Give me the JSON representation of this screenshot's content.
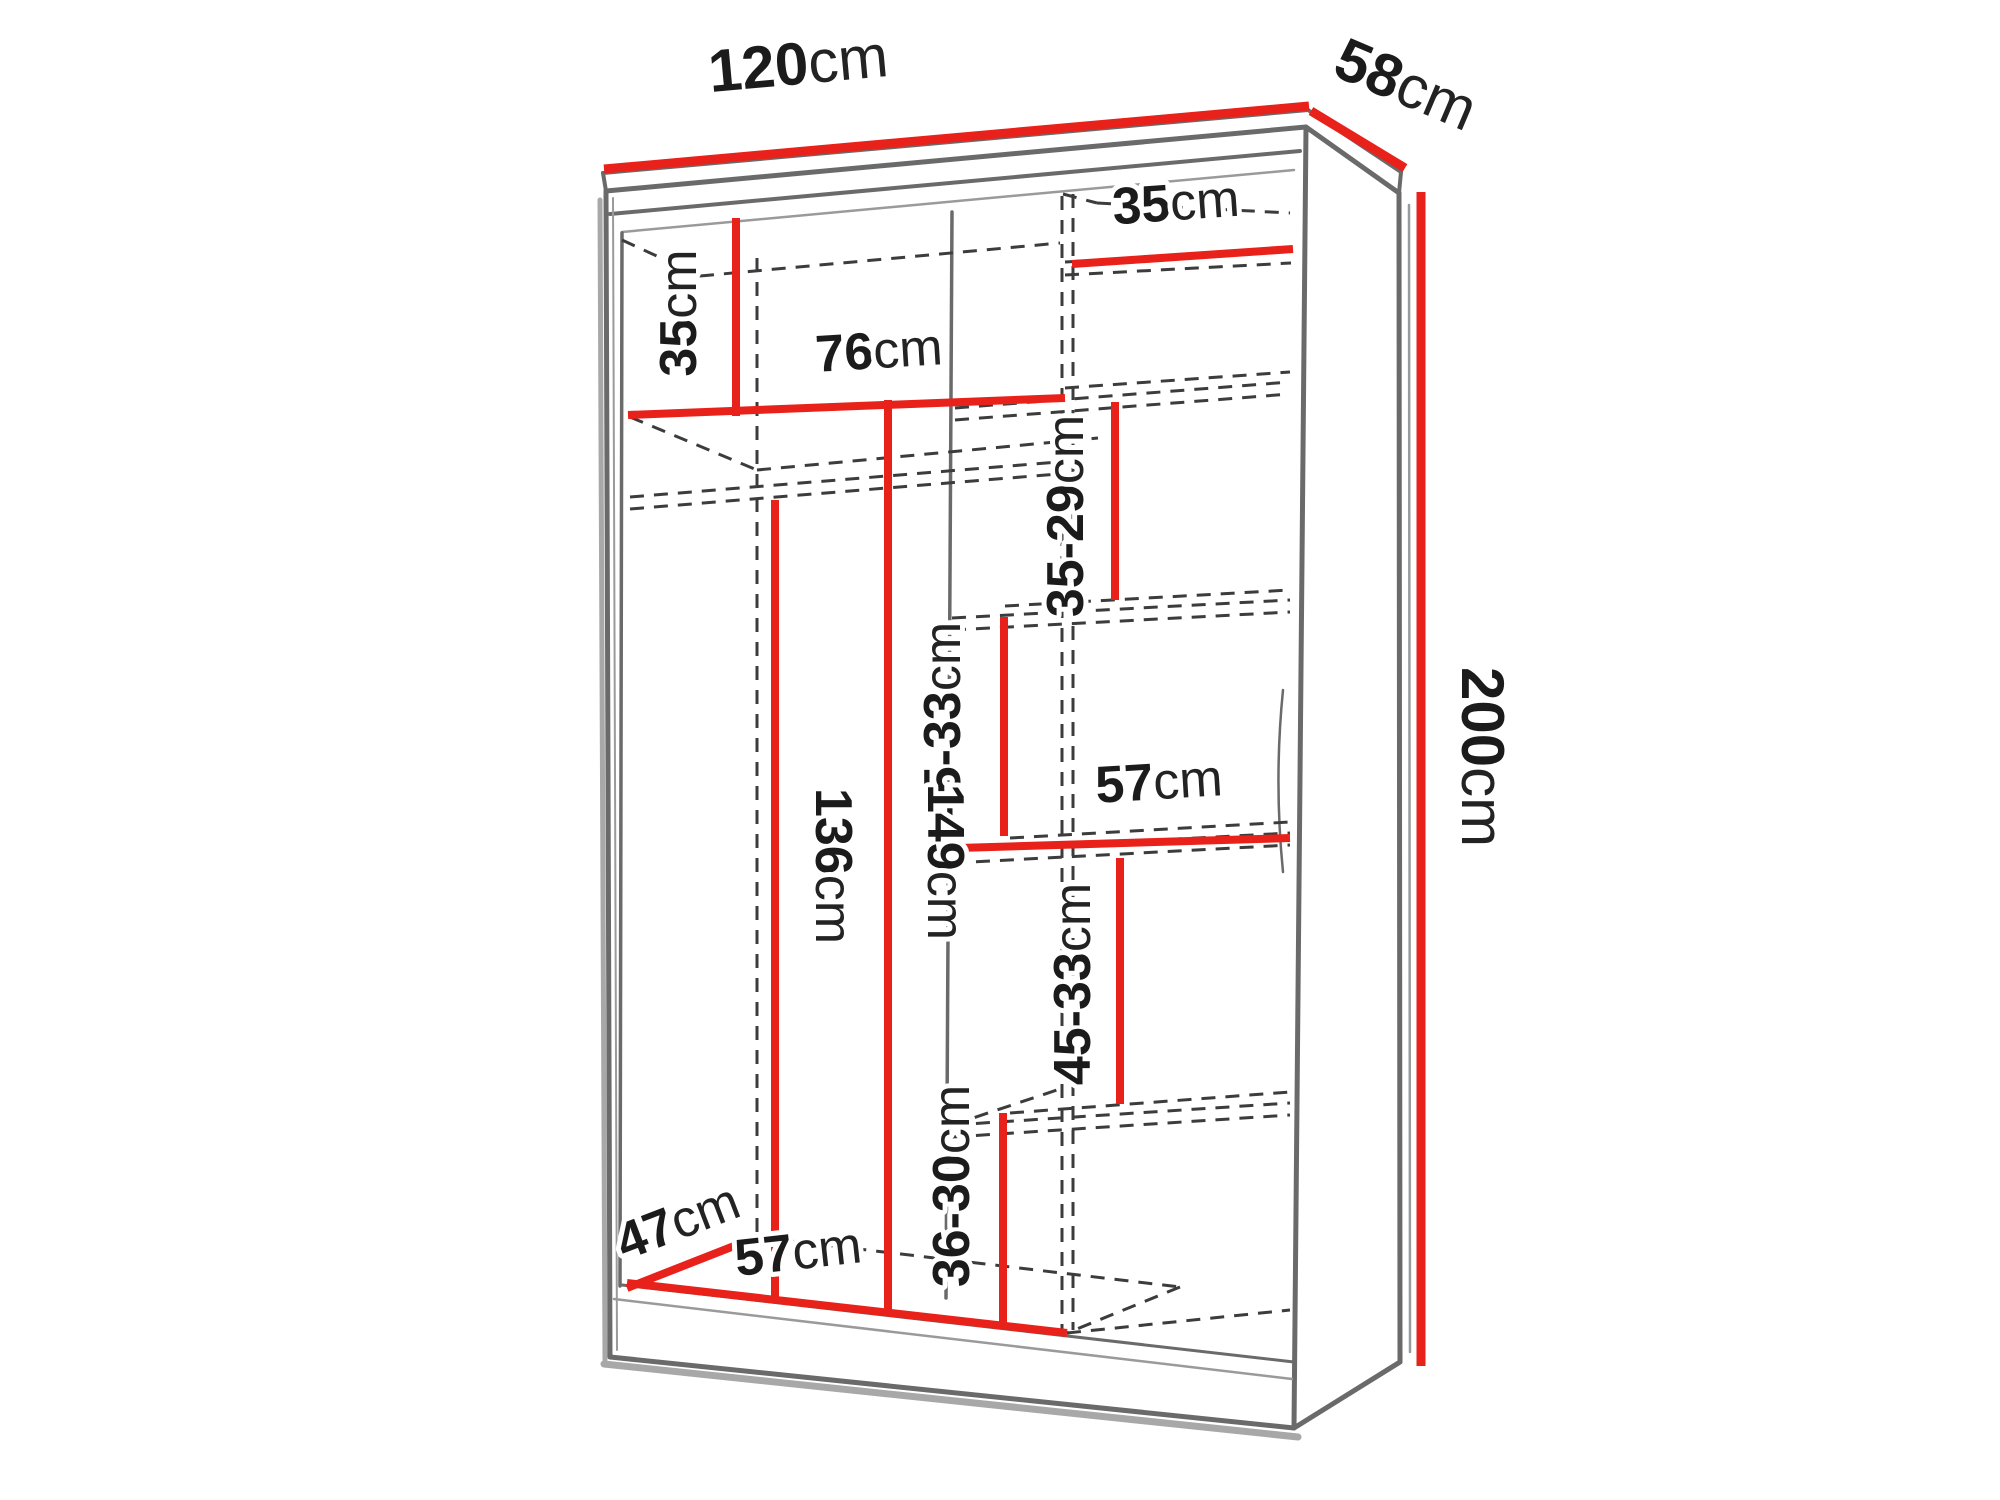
{
  "diagram": {
    "kind": "wardrobe-dimension-diagram",
    "unit": "cm",
    "overall": {
      "width": "120cm",
      "depth": "58cm",
      "height": "200cm"
    },
    "labels": {
      "width_top": {
        "num": "120",
        "unit": "cm"
      },
      "depth_top": {
        "num": "58",
        "unit": "cm"
      },
      "height_right": {
        "num": "200",
        "unit": "cm"
      },
      "left_top_section": {
        "num": "35",
        "unit": "cm"
      },
      "right_top_width": {
        "num": "35",
        "unit": "cm"
      },
      "left_section_width": {
        "num": "76",
        "unit": "cm"
      },
      "right_gap_upper": {
        "num": "35-29",
        "unit": "cm"
      },
      "right_gap_middle": {
        "num": "45-33",
        "unit": "cm"
      },
      "middle_shelf_width": {
        "num": "57",
        "unit": "cm"
      },
      "right_gap_lower": {
        "num": "45-33",
        "unit": "cm"
      },
      "hanging_height_inner": {
        "num": "136",
        "unit": "cm"
      },
      "hanging_height_outer": {
        "num": "149",
        "unit": "cm"
      },
      "bottom_gap": {
        "num": "36-30",
        "unit": "cm"
      },
      "interior_depth": {
        "num": "47",
        "unit": "cm"
      },
      "bottom_width": {
        "num": "57",
        "unit": "cm"
      }
    },
    "colors": {
      "dimension_line": "#e8211a",
      "structure_line": "#6a6a6a",
      "hidden_line": "#3c3c3c",
      "label_text": "#1b1b1b",
      "background": "#ffffff"
    }
  }
}
